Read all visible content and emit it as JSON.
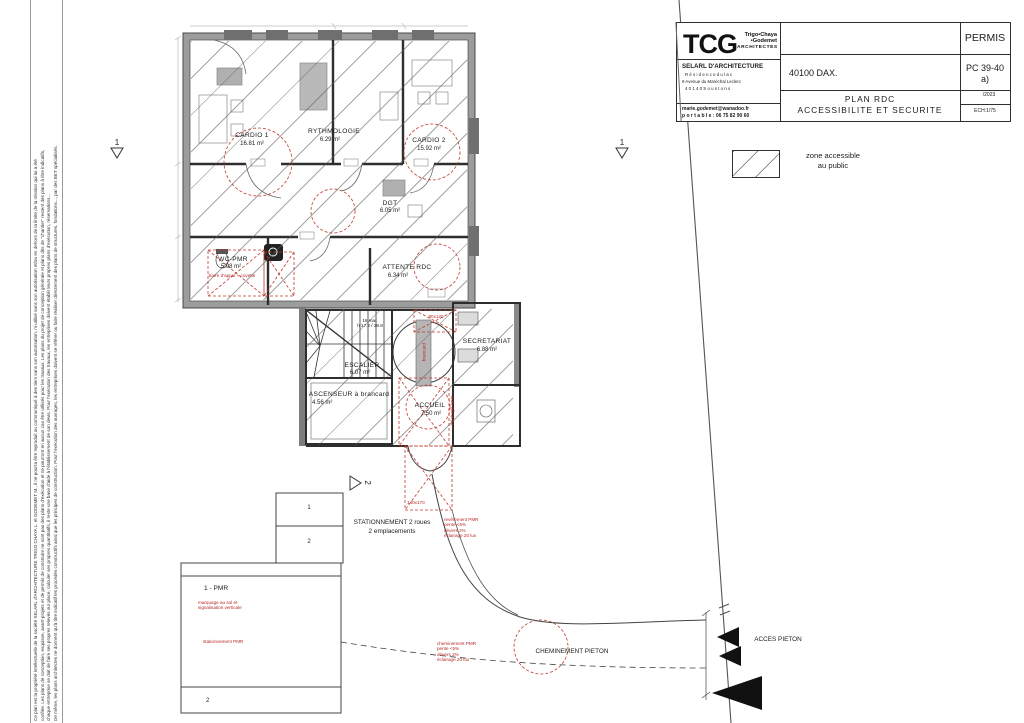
{
  "title_block": {
    "logo": "TCG",
    "logo_sub1": "Trigo•Chaya",
    "logo_sub2": "•Godemet",
    "logo_sub3": "ARCHITECTES",
    "firm": "SELARL D'ARCHITECTURE",
    "address1": "R é s i d e n c e   d u   l a c",
    "address2": "9 Avenue du Maréchal Leclerc",
    "address3": "4 0 1 4 0   S o u s t o n s",
    "email": "marie.godemet@wanadoo.fr",
    "phone": "p o r t a b l e : 06 75 82 90 60",
    "city": "40100 DAX.",
    "permit": "PERMIS",
    "pc_line1": "PC 39-40",
    "pc_line2": "a)",
    "date": "/2023",
    "scale": "ECH:1/75",
    "plan_title_line1": "PLAN RDC",
    "plan_title_line2": "ACCESSIBILITE ET SECURITE"
  },
  "legend": {
    "line1": "zone accessible",
    "line2": "au public"
  },
  "section_markers": {
    "left": "1",
    "right": "1",
    "bottom": "2"
  },
  "rooms": {
    "cardio1": {
      "name": "CARDIO 1",
      "area": "16.81 m²"
    },
    "rythmologie": {
      "name": "RYTHMOLOGIE",
      "area": "6.29 m²"
    },
    "cardio2": {
      "name": "CARDIO 2",
      "area": "15.92 m²"
    },
    "dgt": {
      "name": "DGT",
      "area": "6.05 m²"
    },
    "wc_pmr": {
      "name": "WC-PMR",
      "area": "5.08 m²"
    },
    "attente": {
      "name": "ATTENTE RDC",
      "area": "6.34 m²"
    },
    "escalier": {
      "name": "ESCALIER",
      "area": "6.07 m²"
    },
    "ascenseur": {
      "name": "ASCENSEUR à brancard",
      "area": "4.56 m²"
    },
    "accueil": {
      "name": "ACCUEIL",
      "area": "7.50 m²"
    },
    "secretariat": {
      "name": "SECRETARIAT",
      "area": "6.88 m²"
    }
  },
  "stairs": {
    "note": "16 mar.\nh 17.2 / 28.8"
  },
  "red_annotations": {
    "dim_80x120": "80x120",
    "dim_140x170": "140x170",
    "brancard": "brancard",
    "wc_note": "barre d'appui + cuvette",
    "entrance_note": "éclairage extér.",
    "path_note1": "revêtement PMR\npente <5%\ndévers 2%\néclairage 20 lux",
    "path_note2": "cheminement PMR\npente <5%\ndévers 2%\néclairage 20 lux",
    "parking_marking": "marquage au sol et\nsignalisation verticale",
    "parking_pmr_note": "stationnement PMR"
  },
  "site": {
    "stationnement_line1": "STATIONNEMENT 2 roues",
    "stationnement_line2": "2 emplacements",
    "moto_space1": "1",
    "moto_space2": "2",
    "parking_space_pmr": "1 - PMR",
    "parking_space2": "2",
    "cheminement": "CHEMINEMENT PIETON",
    "acces": "ACCES PIETON"
  },
  "disclaimer": "Ce plan est la propriété intellectuelle de la société SELARL d'ARCHITECTURE TRIGO CHAYA L. et GODEMET M., il ne pourra être reproduit ou communiqué à des tiers sans son autorisation, ni utilisé sans son autorisation et/ou en dehors de la limite de la mission qui lui a été\nconfiée. Les plans de conception, esquisse, avant-projets et de permis de construire ne sont pas des plans d'exécution et ne pourront en aucun cas être utilisés pour les travaux. Les plans du projet de conception générale et plans dits de \"chantier\" restent des plans à titre indicatifs,\nchaque entreprise se doit de faire ses propres relevés sur place, calculer ses propres quantitatifs, il reste une base d'aide à l'établissement de son devis. Pour l'exécution des travaux, les entreprises doivent établir leurs propres plans d'exécution, réservations...\nDe même, les plans architectes ne donnent qu'à titre indicatif les procédés constructifs ainsi que les principes de construction. Pour l'exécution des ouvrages, les entreprises doivent se référer ou faire réaliser directement des plans de structures, fondations..., par des BET spécialisés."
}
